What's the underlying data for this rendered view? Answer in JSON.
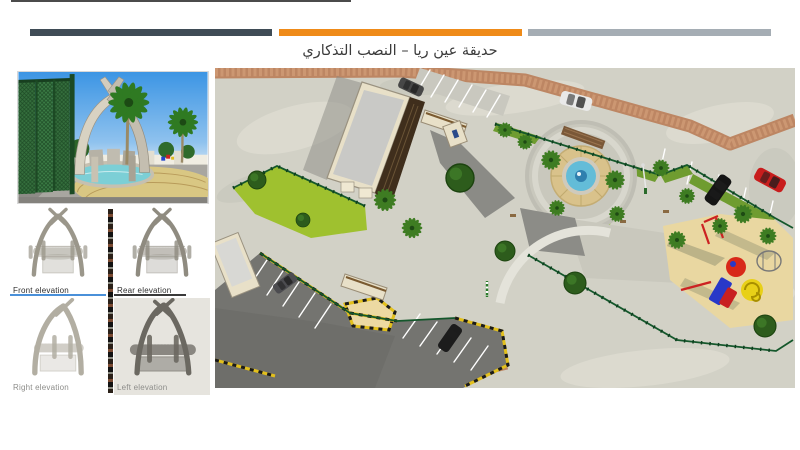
{
  "slide": {
    "title": "حديقة عين ريا – النصب التذكاري",
    "title_color": "#3b3b3b",
    "background": "#ffffff"
  },
  "header_bars": {
    "dark": "#3f4c56",
    "orange": "#ef8b19",
    "gray": "#a5adb4"
  },
  "elevations": [
    {
      "label": "Front elevation",
      "underline_color": "#4a90d9"
    },
    {
      "label": "Rear elevation",
      "underline_color": "#3a3a3a"
    },
    {
      "label": "Right elevation",
      "underline_color": ""
    },
    {
      "label": "Left elevation",
      "underline_color": ""
    }
  ]
}
